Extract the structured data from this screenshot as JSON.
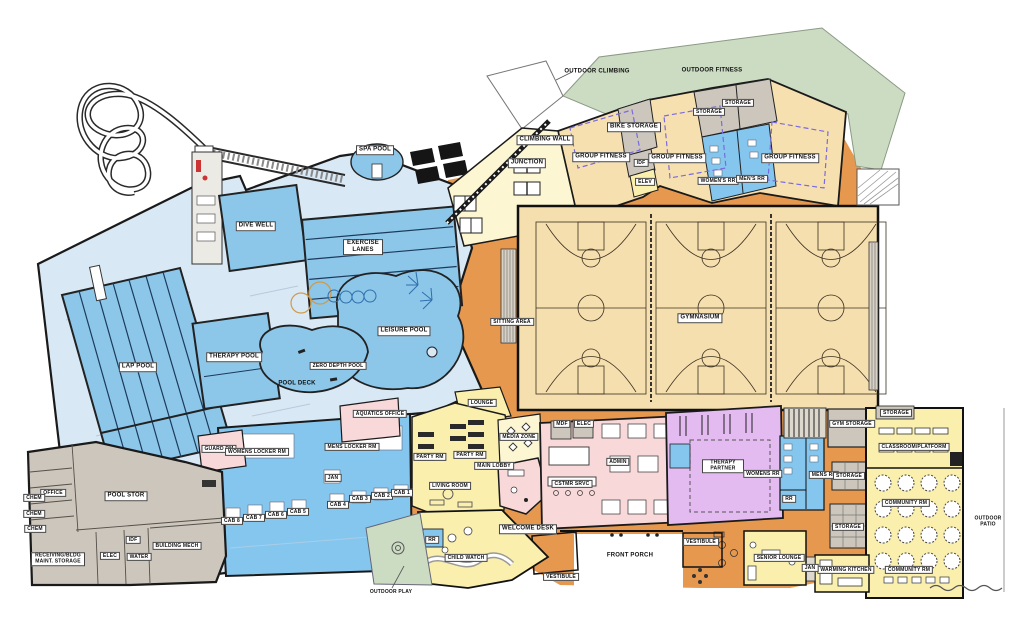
{
  "colors": {
    "pool_water": "#8cc6e8",
    "pool_deck": "#d9e8f5",
    "locker_blue": "#85c6ef",
    "gym_tan": "#f6dfae",
    "fitness_tan": "#f7e0b0",
    "circulation_orange": "#e6984e",
    "program_yellow": "#fbefae",
    "pale_yellow": "#fdf6d2",
    "admin_pink": "#f8d8d8",
    "therapy_purple": "#e3bbf0",
    "service_gray": "#ccc6bc",
    "outdoor_green": "#ccdcc3",
    "wall": "#1a1a1a"
  },
  "outdoor": {
    "outdoor_climbing": "OUTDOOR CLIMBING",
    "outdoor_fitness": "OUTDOOR FITNESS",
    "outdoor_play": "OUTDOOR PLAY",
    "outdoor_patio": "OUTDOOR PATIO",
    "front_porch": "FRONT PORCH"
  },
  "aquatics": {
    "spa_pool": "SPA POOL",
    "dive_well": "DIVE WELL",
    "exercise_lanes": "EXERCISE LANES",
    "lap_pool": "LAP POOL",
    "therapy_pool": "THERAPY POOL",
    "zero_depth_pool": "ZERO DEPTH POOL",
    "leisure_pool": "LEISURE POOL",
    "pool_deck": "POOL DECK",
    "aquatics_office": "AQUATICS OFFICE",
    "guard_rm": "GUARD RM",
    "womens_locker_rm": "WOMENS LOCKER RM",
    "mens_locker_rm": "MENS LOCKER RM",
    "jan": "JAN",
    "cabanas": [
      "CAB 1",
      "CAB 2",
      "CAB 3",
      "CAB 4",
      "CAB 5",
      "CAB 6",
      "CAB 7",
      "CAB 8"
    ]
  },
  "service": {
    "office": "OFFICE",
    "chem": "CHEM",
    "pool_stor": "POOL STOR",
    "receiving": "RECEIVING/BLDG MAINT. STORAGE",
    "elec": "ELEC",
    "water": "WATER",
    "idf": "IDF",
    "building_mech": "BUILDING MECH"
  },
  "fitness": {
    "climbing_wall": "CLIMBING WALL",
    "junction": "JUNCTION",
    "bike_storage": "BIKE STORAGE",
    "group_fitness": "GROUP FITNESS",
    "idf": "IDF",
    "elev": "ELEV",
    "storage": "STORAGE",
    "womens_rr": "WOMEN'S RR",
    "mens_rr": "MEN'S RR"
  },
  "gym": {
    "gymnasium": "GYMNASIUM",
    "sitting_area": "SITTING AREA",
    "gym_storage": "GYM STORAGE"
  },
  "lobby": {
    "main_lobby": "MAIN LOBBY",
    "welcome_desk": "WELCOME DESK",
    "media_zone": "MEDIA ZONE",
    "lounge": "LOUNGE",
    "party_rm": "PARTY RM",
    "living_room": "LIVING ROOM",
    "child_watch": "CHILD WATCH",
    "rr": "RR",
    "vestibule": "VESTIBULE",
    "mdf": "MDF",
    "elec": "ELEC",
    "admin": "ADMIN",
    "cstmr_srvc": "CSTMR SRVC"
  },
  "therapy": {
    "therapy_partner": "THERAPY PARTNER",
    "womens_rr": "WOMENS RR",
    "mens_rr": "MENS RR",
    "rr": "RR",
    "storage": "STORAGE"
  },
  "community": {
    "storage": "STORAGE",
    "classroom_platform": "CLASSROOM/PLATFORM",
    "community_rm": "COMMUNITY RM",
    "warming_kitchen": "WARMING KITCHEN",
    "senior_lounge": "SENIOR LOUNGE",
    "jan": "JAN"
  }
}
